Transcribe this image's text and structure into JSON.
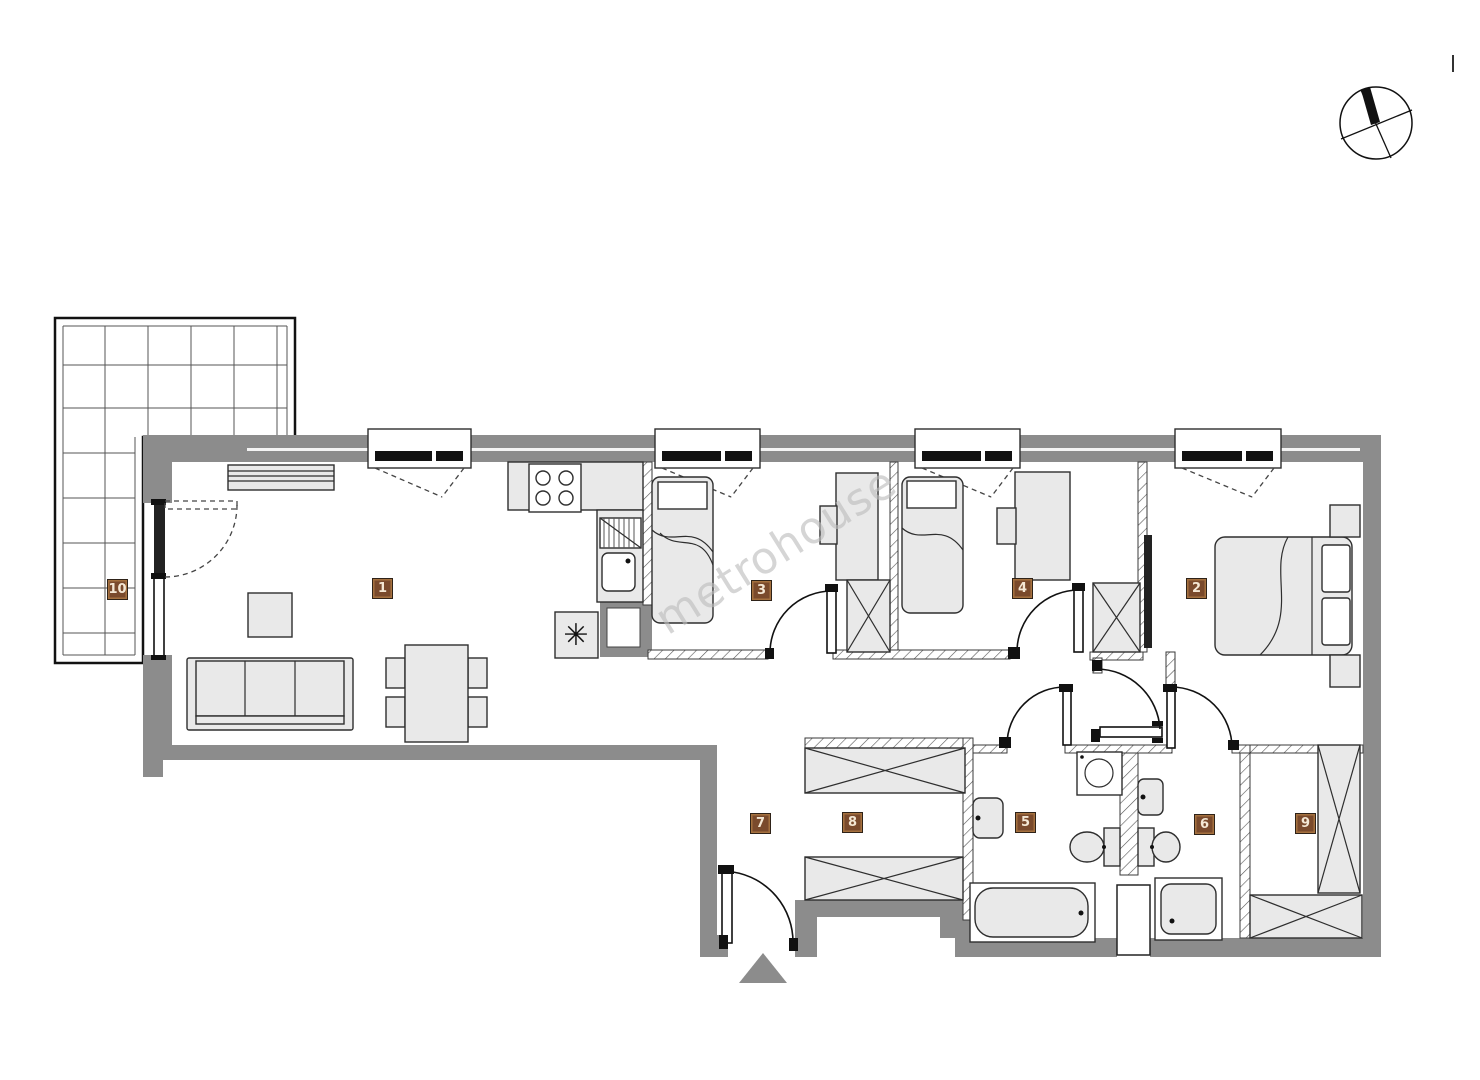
{
  "watermark": "metrohouse",
  "room_labels": {
    "r1": "1",
    "r2": "2",
    "r3": "3",
    "r4": "4",
    "r5": "5",
    "r6": "6",
    "r7": "7",
    "r8": "8",
    "r9": "9",
    "r10": "10"
  },
  "colors": {
    "wall": "#8c8c8c",
    "furniture": "#e9e9e9",
    "outline": "#2e2e2e",
    "label-bg": "#7a4a2c",
    "label-border": "#a5713f",
    "label-text": "#f4e7d4",
    "watermark": "#bcbcbc"
  }
}
